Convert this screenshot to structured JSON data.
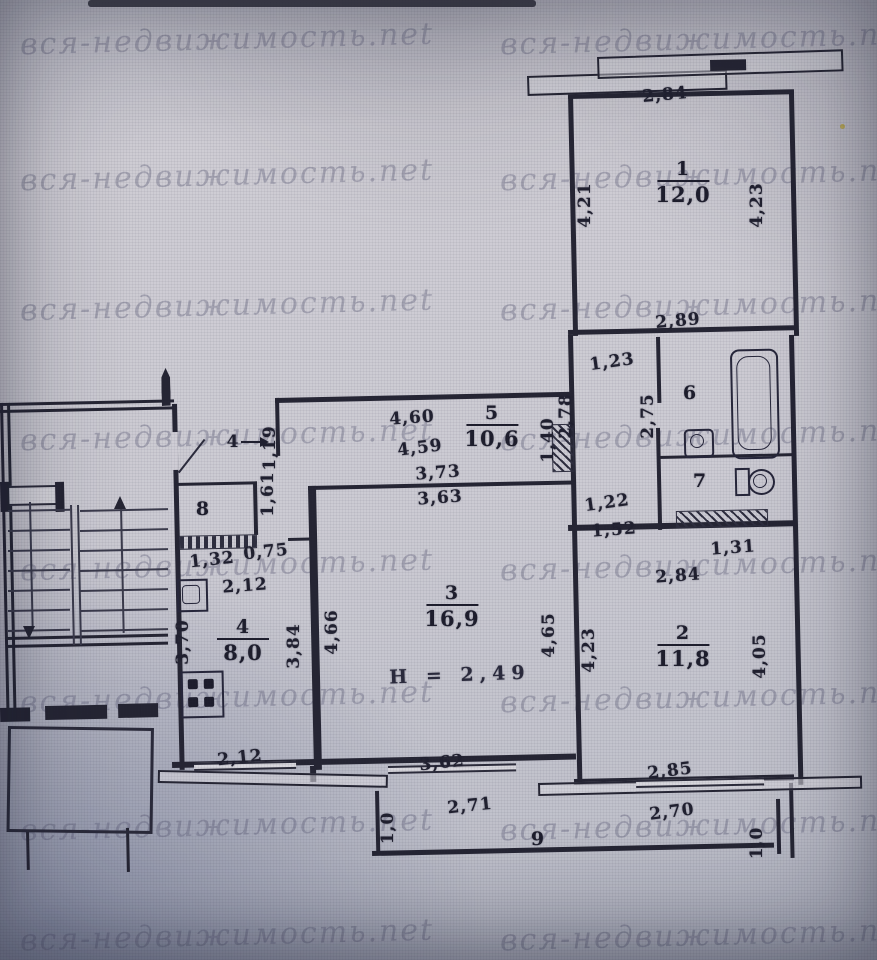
{
  "watermark": {
    "text": "вся-недвижимость.net"
  },
  "plan": {
    "height_note": "Н = 2,49",
    "rooms": [
      {
        "id": "room-1",
        "number": "1",
        "area": "12,0",
        "x": 683,
        "y": 158
      },
      {
        "id": "room-2",
        "number": "2",
        "area": "11,8",
        "x": 683,
        "y": 622
      },
      {
        "id": "room-3",
        "number": "3",
        "area": "16,9",
        "x": 452,
        "y": 582
      },
      {
        "id": "room-4",
        "number": "4",
        "area": "8,0",
        "x": 243,
        "y": 616
      },
      {
        "id": "room-5",
        "number": "5",
        "area": "10,6",
        "x": 492,
        "y": 402
      },
      {
        "id": "room-6",
        "number": "6",
        "area": "",
        "x": 690,
        "y": 382
      },
      {
        "id": "room-7",
        "number": "7",
        "area": "",
        "x": 700,
        "y": 470
      },
      {
        "id": "room-8",
        "number": "8",
        "area": "",
        "x": 203,
        "y": 498
      },
      {
        "id": "room-9",
        "number": "9",
        "area": "",
        "x": 538,
        "y": 828
      }
    ],
    "entry_mark": {
      "label": "4",
      "x": 233,
      "y": 442
    },
    "dimensions": [
      {
        "text": "2,84",
        "x": 665,
        "y": 95,
        "rot": -5
      },
      {
        "text": "4,21",
        "x": 585,
        "y": 205,
        "vertical": true
      },
      {
        "text": "4,23",
        "x": 757,
        "y": 205,
        "vertical": true
      },
      {
        "text": "2,89",
        "x": 678,
        "y": 321,
        "rot": -5
      },
      {
        "text": "1,23",
        "x": 612,
        "y": 362,
        "rot": -8
      },
      {
        "text": "2,78",
        "x": 566,
        "y": 416,
        "vertical": true
      },
      {
        "text": "2,75",
        "x": 648,
        "y": 416,
        "vertical": true
      },
      {
        "text": "1,22",
        "x": 607,
        "y": 503,
        "rot": -8
      },
      {
        "text": "1,52",
        "x": 614,
        "y": 530,
        "rot": -4
      },
      {
        "text": "1,31",
        "x": 733,
        "y": 548,
        "rot": -4
      },
      {
        "text": "2,84",
        "x": 678,
        "y": 576,
        "rot": -4
      },
      {
        "text": "4,23",
        "x": 589,
        "y": 650,
        "vertical": true
      },
      {
        "text": "4,05",
        "x": 760,
        "y": 656,
        "vertical": true
      },
      {
        "text": "1,40",
        "x": 548,
        "y": 440,
        "vertical": true
      },
      {
        "text": "4,60",
        "x": 412,
        "y": 418,
        "rot": -4
      },
      {
        "text": "4,59",
        "x": 420,
        "y": 448,
        "rot": -7
      },
      {
        "text": "3,73",
        "x": 438,
        "y": 473,
        "rot": -4
      },
      {
        "text": "3,63",
        "x": 440,
        "y": 498,
        "rot": -4
      },
      {
        "text": "4,66",
        "x": 332,
        "y": 632,
        "vertical": true
      },
      {
        "text": "3,84",
        "x": 294,
        "y": 646,
        "vertical": true
      },
      {
        "text": "4,65",
        "x": 549,
        "y": 635,
        "vertical": true
      },
      {
        "text": "1,32",
        "x": 212,
        "y": 560,
        "rot": -6
      },
      {
        "text": "0,75",
        "x": 266,
        "y": 552,
        "rot": -6
      },
      {
        "text": "2,12",
        "x": 245,
        "y": 586,
        "rot": -4
      },
      {
        "text": "3,70",
        "x": 183,
        "y": 642,
        "vertical": true
      },
      {
        "text": "1,19",
        "x": 270,
        "y": 448,
        "vertical": true
      },
      {
        "text": "1,61",
        "x": 268,
        "y": 494,
        "vertical": true
      },
      {
        "text": "2,12",
        "x": 240,
        "y": 758,
        "rot": -6
      },
      {
        "text": "3,62",
        "x": 442,
        "y": 763,
        "rot": -6
      },
      {
        "text": "2,71",
        "x": 470,
        "y": 806,
        "rot": -6
      },
      {
        "text": "2,85",
        "x": 670,
        "y": 771,
        "rot": -7
      },
      {
        "text": "2,70",
        "x": 672,
        "y": 812,
        "rot": -7
      },
      {
        "text": "1,0",
        "x": 388,
        "y": 828,
        "vertical": true
      },
      {
        "text": "1,0",
        "x": 757,
        "y": 843,
        "vertical": true
      }
    ]
  }
}
